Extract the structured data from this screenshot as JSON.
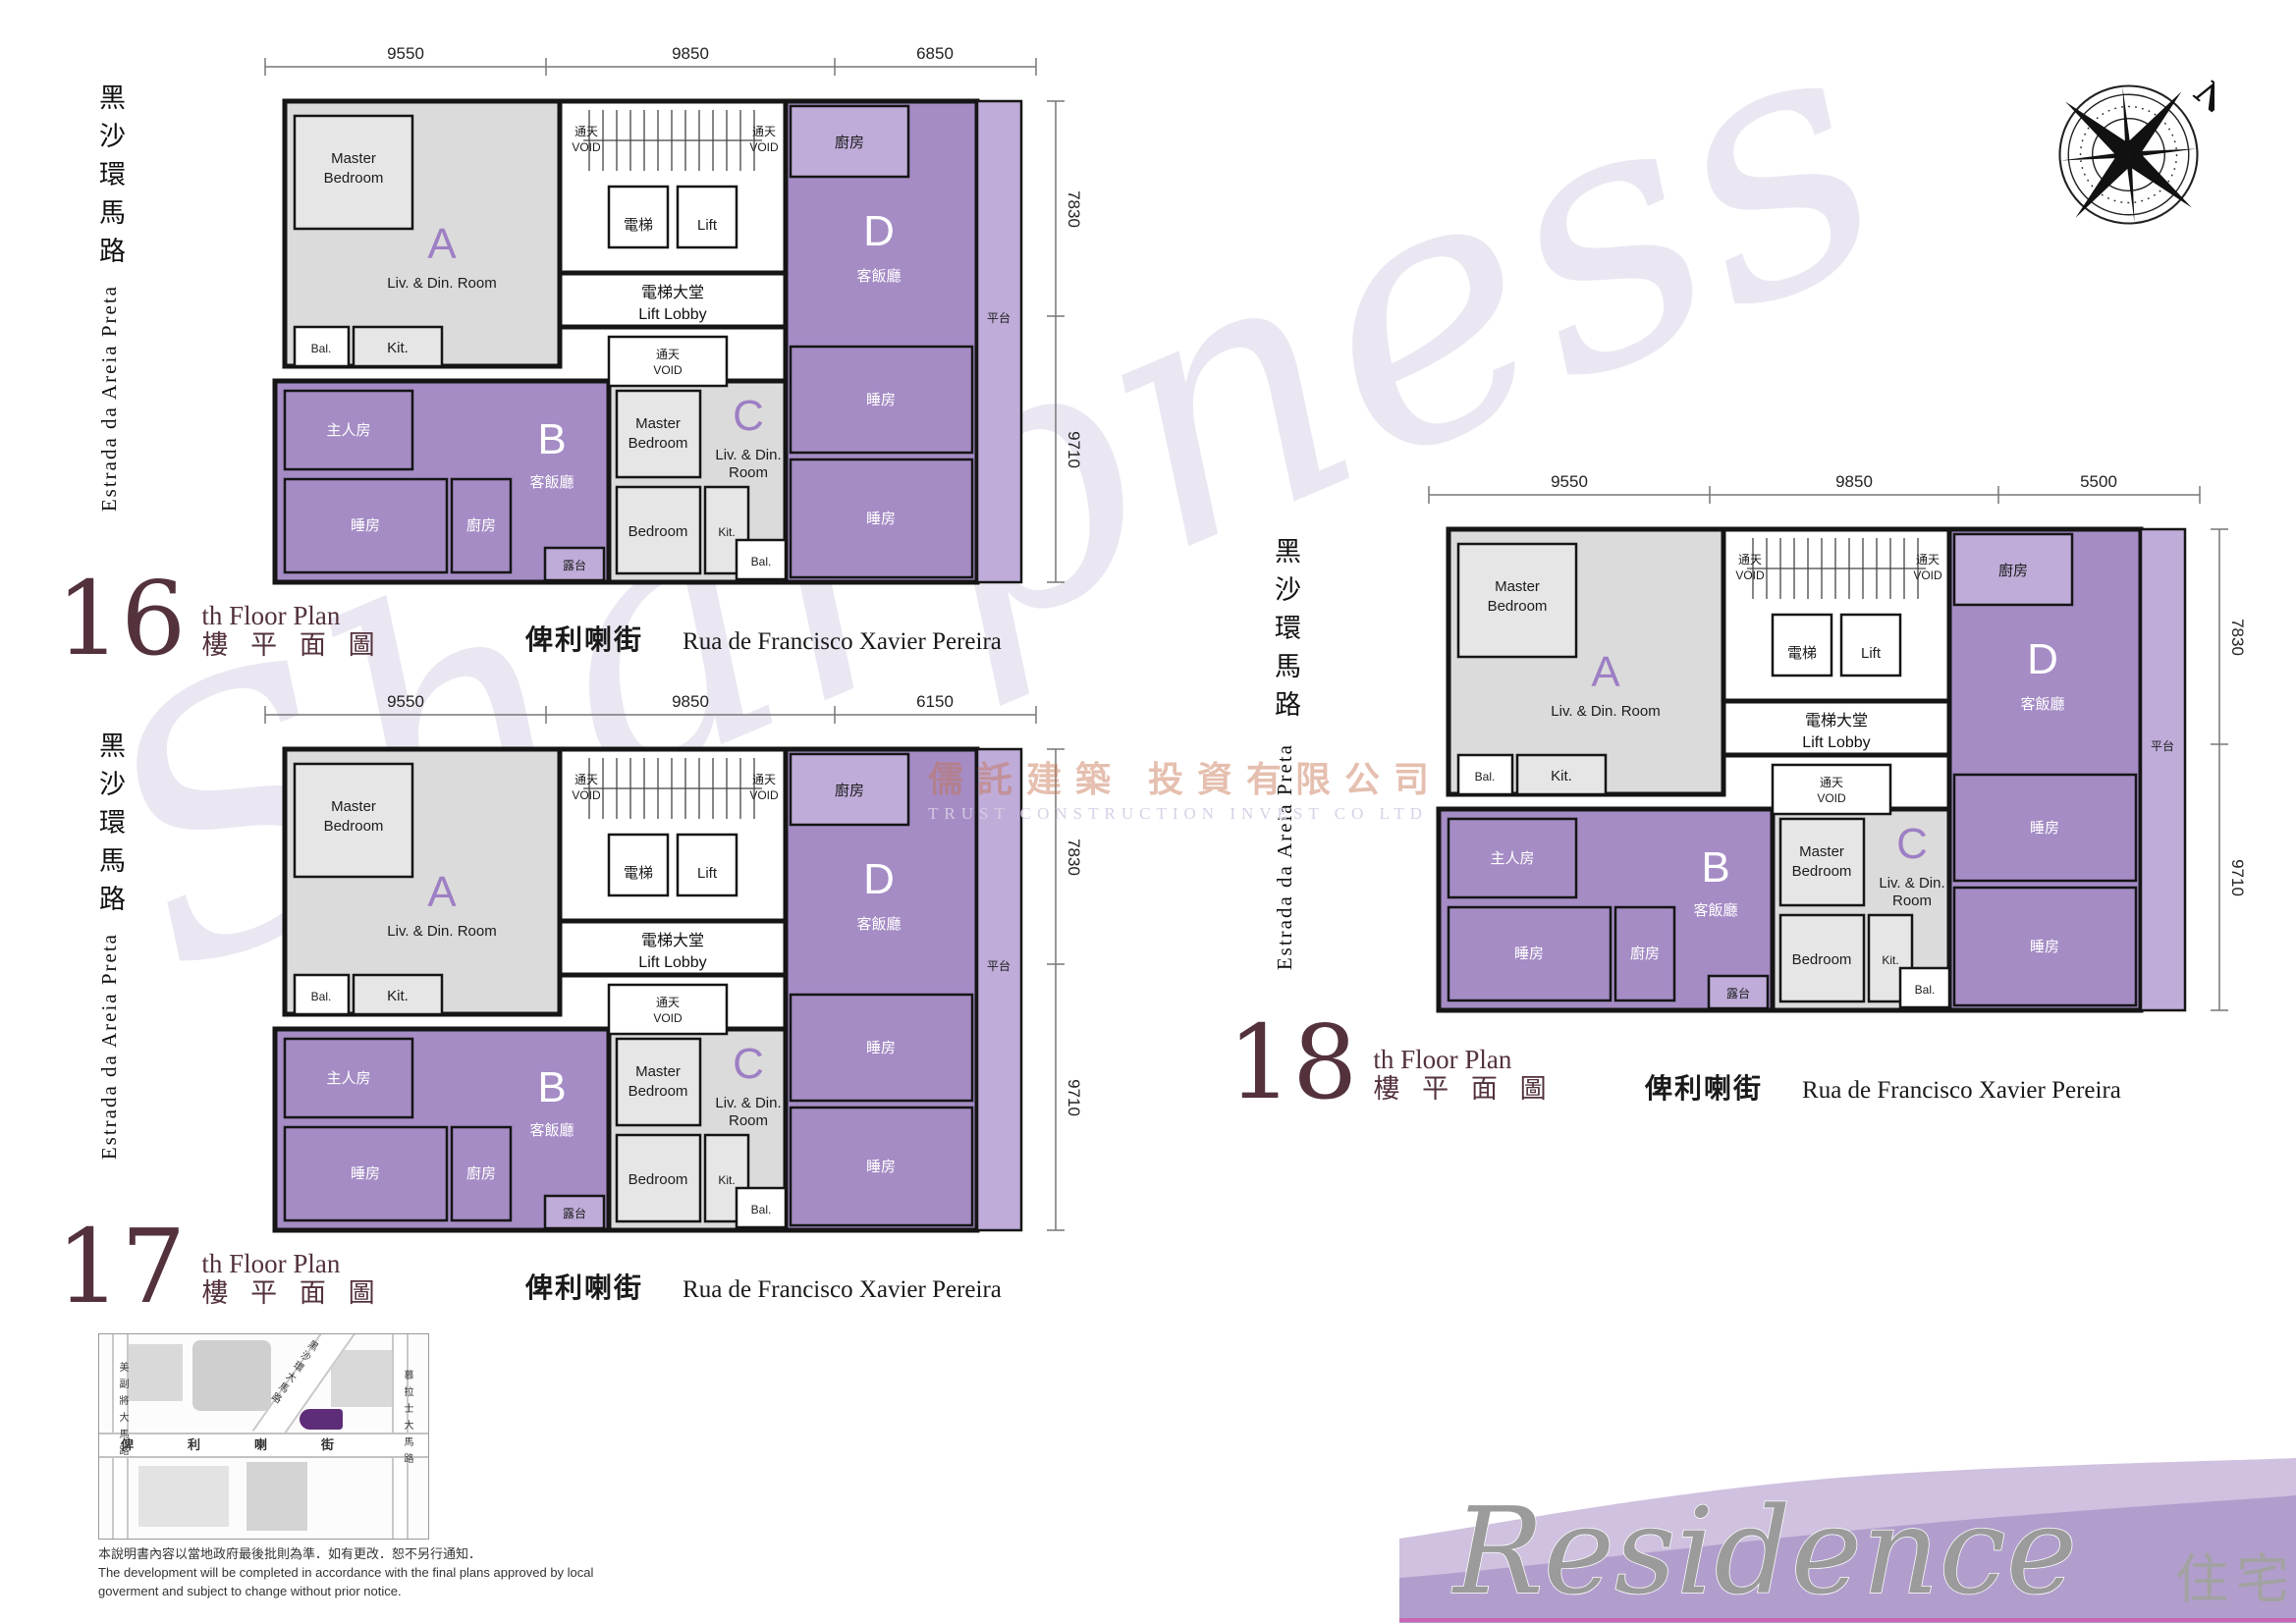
{
  "page": {
    "watermark_script": "Sharpness",
    "watermark_logo_cn": "儒託建築 投資有限公司",
    "watermark_logo_en": "TRUST CONSTRUCTION INVEST CO LTD",
    "compass_n": "N"
  },
  "colors": {
    "unit_purple": "#a58cc5",
    "unit_purple_light": "#bfacd9",
    "unit_gray": "#dcdbdb",
    "wall": "#151515",
    "title_maroon": "#53323c",
    "wave_back": "#cfc1df",
    "wave_front": "#b19ecd",
    "wave_edge_pink": "#cb66b4",
    "site_marker": "#5e2d79"
  },
  "streets": {
    "side_cn": "黑沙環馬路",
    "side_en": "Estrada da Areia Preta",
    "bottom_cn": "俾利喇街",
    "bottom_en": "Rua de Francisco Xavier Pereira"
  },
  "titles": {
    "suffix_en": "th Floor Plan",
    "suffix_cn": "樓 平 面 圖"
  },
  "plans": [
    {
      "number": "16",
      "dims_top": [
        "9550",
        "9850",
        "6850"
      ],
      "dims_right": [
        "7830",
        "9710"
      ]
    },
    {
      "number": "17",
      "dims_top": [
        "9550",
        "9850",
        "6150"
      ],
      "dims_right": [
        "7830",
        "9710"
      ]
    },
    {
      "number": "18",
      "dims_top": [
        "9550",
        "9850",
        "5500"
      ],
      "dims_right": [
        "7830",
        "9710"
      ]
    }
  ],
  "plan_labels": {
    "units": [
      "A",
      "B",
      "C",
      "D"
    ],
    "master_en": "Master Bedroom",
    "bedroom_en": "Bedroom",
    "liv_din": "Liv. & Din. Room",
    "kit": "Kit.",
    "bal": "Bal.",
    "void_cn": "通天",
    "void_en": "VOID",
    "lift_cn": "電梯",
    "lift_en": "Lift",
    "lobby_cn": "電梯大堂",
    "lobby_en": "Lift Lobby",
    "master_cn": "主人房",
    "living_cn": "客飯廳",
    "bed_cn": "睡房",
    "kitchen_cn": "廚房",
    "balcony_cn": "露台",
    "terrace_cn": "平台"
  },
  "map": {
    "street_left": "美副將大馬路",
    "street_mid": "俾利喇街",
    "street_diag": "黑沙環大馬路",
    "street_right": "慕拉士大馬路",
    "disclaimer_cn": "本說明書內容以當地政府最後批則為準．如有更改．恕不另行通知．",
    "disclaimer_en1": "The development will be completed in accordance with the final plans approved by local",
    "disclaimer_en2": "goverment and subject to change without prior notice."
  },
  "footer": {
    "residence": "Residence",
    "residence_cn": "住宅"
  }
}
